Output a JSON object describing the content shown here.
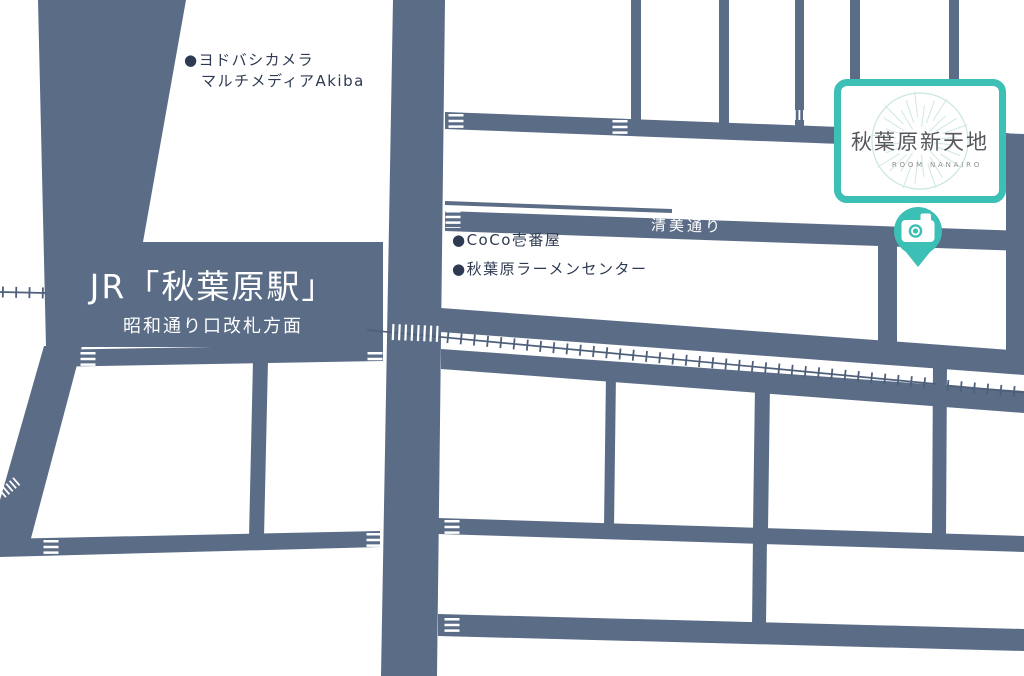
{
  "station": {
    "title": "JR「秋葉原駅」",
    "subtitle": "昭和通り口改札方面"
  },
  "streets": {
    "kiyomi": "清美通り"
  },
  "pois": {
    "yodobashi": {
      "line1": "●ヨドバシカメラ",
      "line2": "マルチメディアAkiba"
    },
    "coco": {
      "label": "●CoCo壱番屋"
    },
    "ramen": {
      "label": "●秋葉原ラーメンセンター"
    }
  },
  "logo": {
    "title": "秋葉原新天地",
    "subtitle": "ROOM NANAIRO"
  },
  "icons": {
    "pin": "camera-map-pin"
  },
  "colors": {
    "road": "#5b6c87",
    "rail": "#4e5f79",
    "label_text": "#2e3a52",
    "accent_teal": "#3cbfb4",
    "background": "#ffffff"
  }
}
